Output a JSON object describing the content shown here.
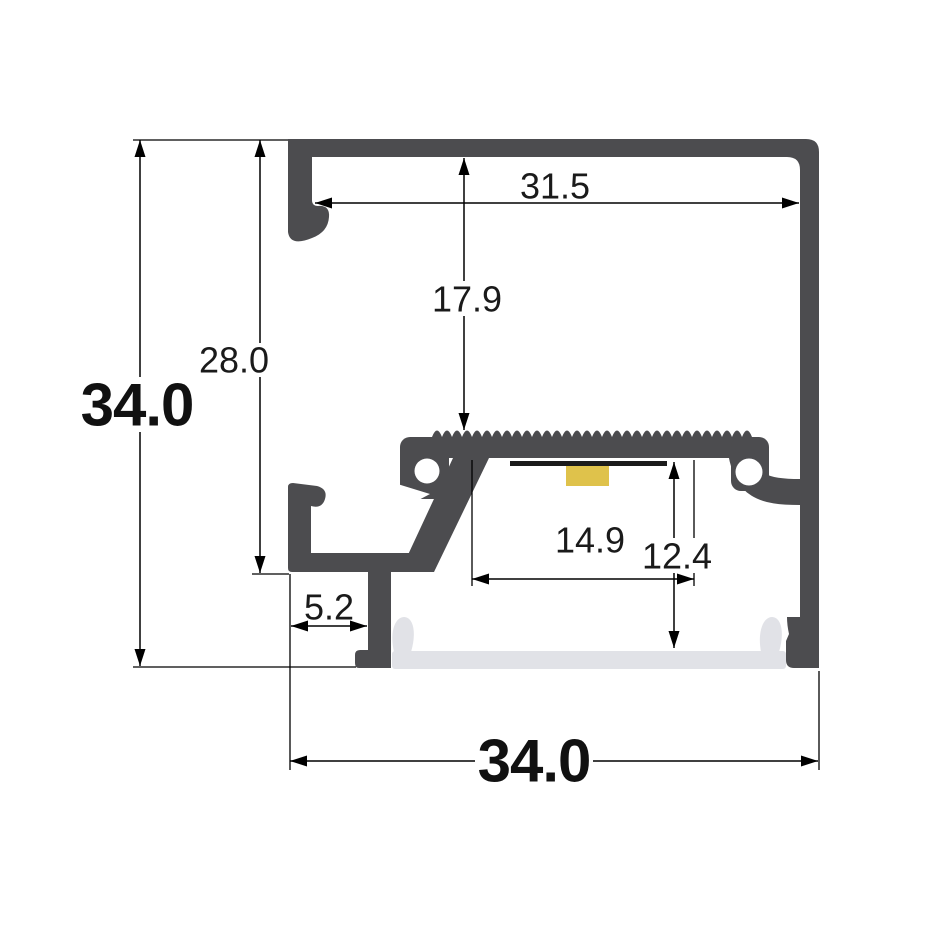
{
  "colors": {
    "background": "#FFFFFF",
    "profile_body": "#4C4C4F",
    "diffuser": "#E1E2E7",
    "led_pcb": "#1B1B1B",
    "led_chip": "#DFC24B",
    "dimension": "#000000"
  },
  "dimensions": {
    "overall_height": "34.0",
    "inner_height": "28.0",
    "top_inner_width": "31.5",
    "depth_to_led_platform": "17.9",
    "led_platform_width": "14.9",
    "cavity_depth": "12.4",
    "foot_offset": "5.2",
    "overall_width": "34.0"
  }
}
